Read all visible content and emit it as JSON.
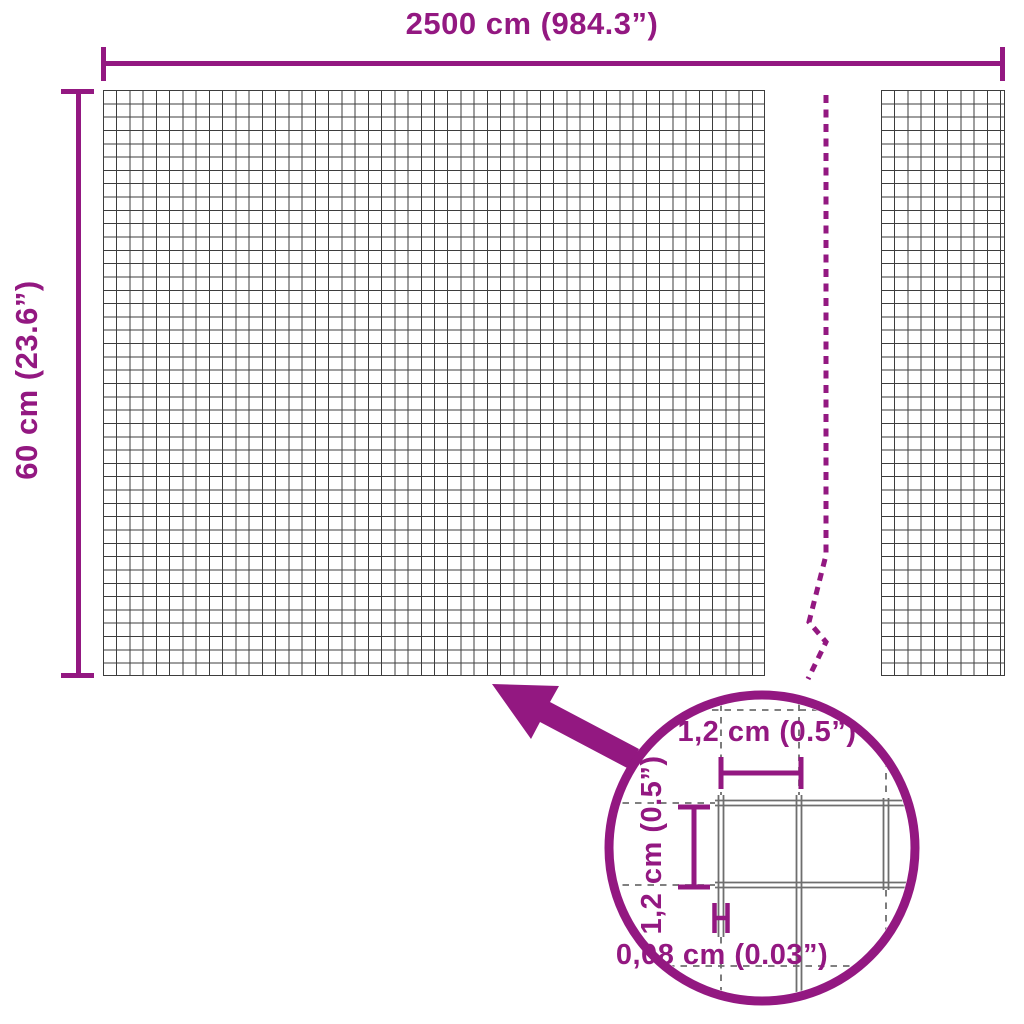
{
  "colors": {
    "accent": "#931881",
    "mesh_grid_line": "#3d3d3d",
    "detail_wire": "#6e6e6e",
    "background": "#ffffff"
  },
  "main_dimensions": {
    "width_label": "2500 cm (984.3”)",
    "height_label": "60 cm (23.6”)"
  },
  "detail_view": {
    "mesh_opening_width_label": "1,2 cm (0.5”)",
    "mesh_opening_height_label": "1,2 cm (0.5”)",
    "wire_thickness_label": "0,08 cm (0.03”)"
  }
}
